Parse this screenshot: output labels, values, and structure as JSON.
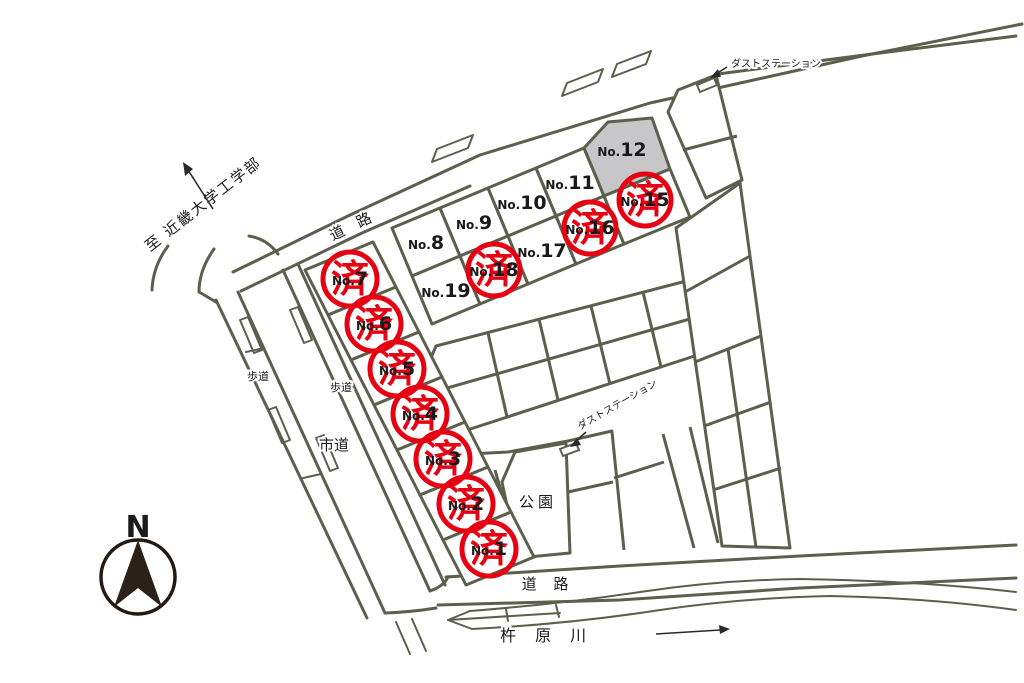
{
  "map": {
    "compass_label": "N",
    "stamp": "済",
    "lot_prefix": "No.",
    "colors": {
      "line": "#5b5f4c",
      "stamp_red": "#e60011",
      "reserved_gray": "#c7c7c9"
    },
    "labels": {
      "to_university": "至 近畿大学工学部",
      "road_top": "道 路",
      "road_bottom": "道 路",
      "city_road": "市道",
      "sidewalk": "歩道",
      "park": "公園",
      "river": "杵 原 川",
      "dust_station": "ダストステーション"
    },
    "lots": [
      {
        "number": "1",
        "sold": true
      },
      {
        "number": "2",
        "sold": true
      },
      {
        "number": "3",
        "sold": true
      },
      {
        "number": "4",
        "sold": true
      },
      {
        "number": "5",
        "sold": true
      },
      {
        "number": "6",
        "sold": true
      },
      {
        "number": "7",
        "sold": true
      },
      {
        "number": "8",
        "sold": false
      },
      {
        "number": "9",
        "sold": false
      },
      {
        "number": "10",
        "sold": false
      },
      {
        "number": "11",
        "sold": false
      },
      {
        "number": "12",
        "sold": false
      },
      {
        "number": "15",
        "sold": true
      },
      {
        "number": "16",
        "sold": true
      },
      {
        "number": "17",
        "sold": false
      },
      {
        "number": "18",
        "sold": true
      },
      {
        "number": "19",
        "sold": false
      }
    ]
  }
}
